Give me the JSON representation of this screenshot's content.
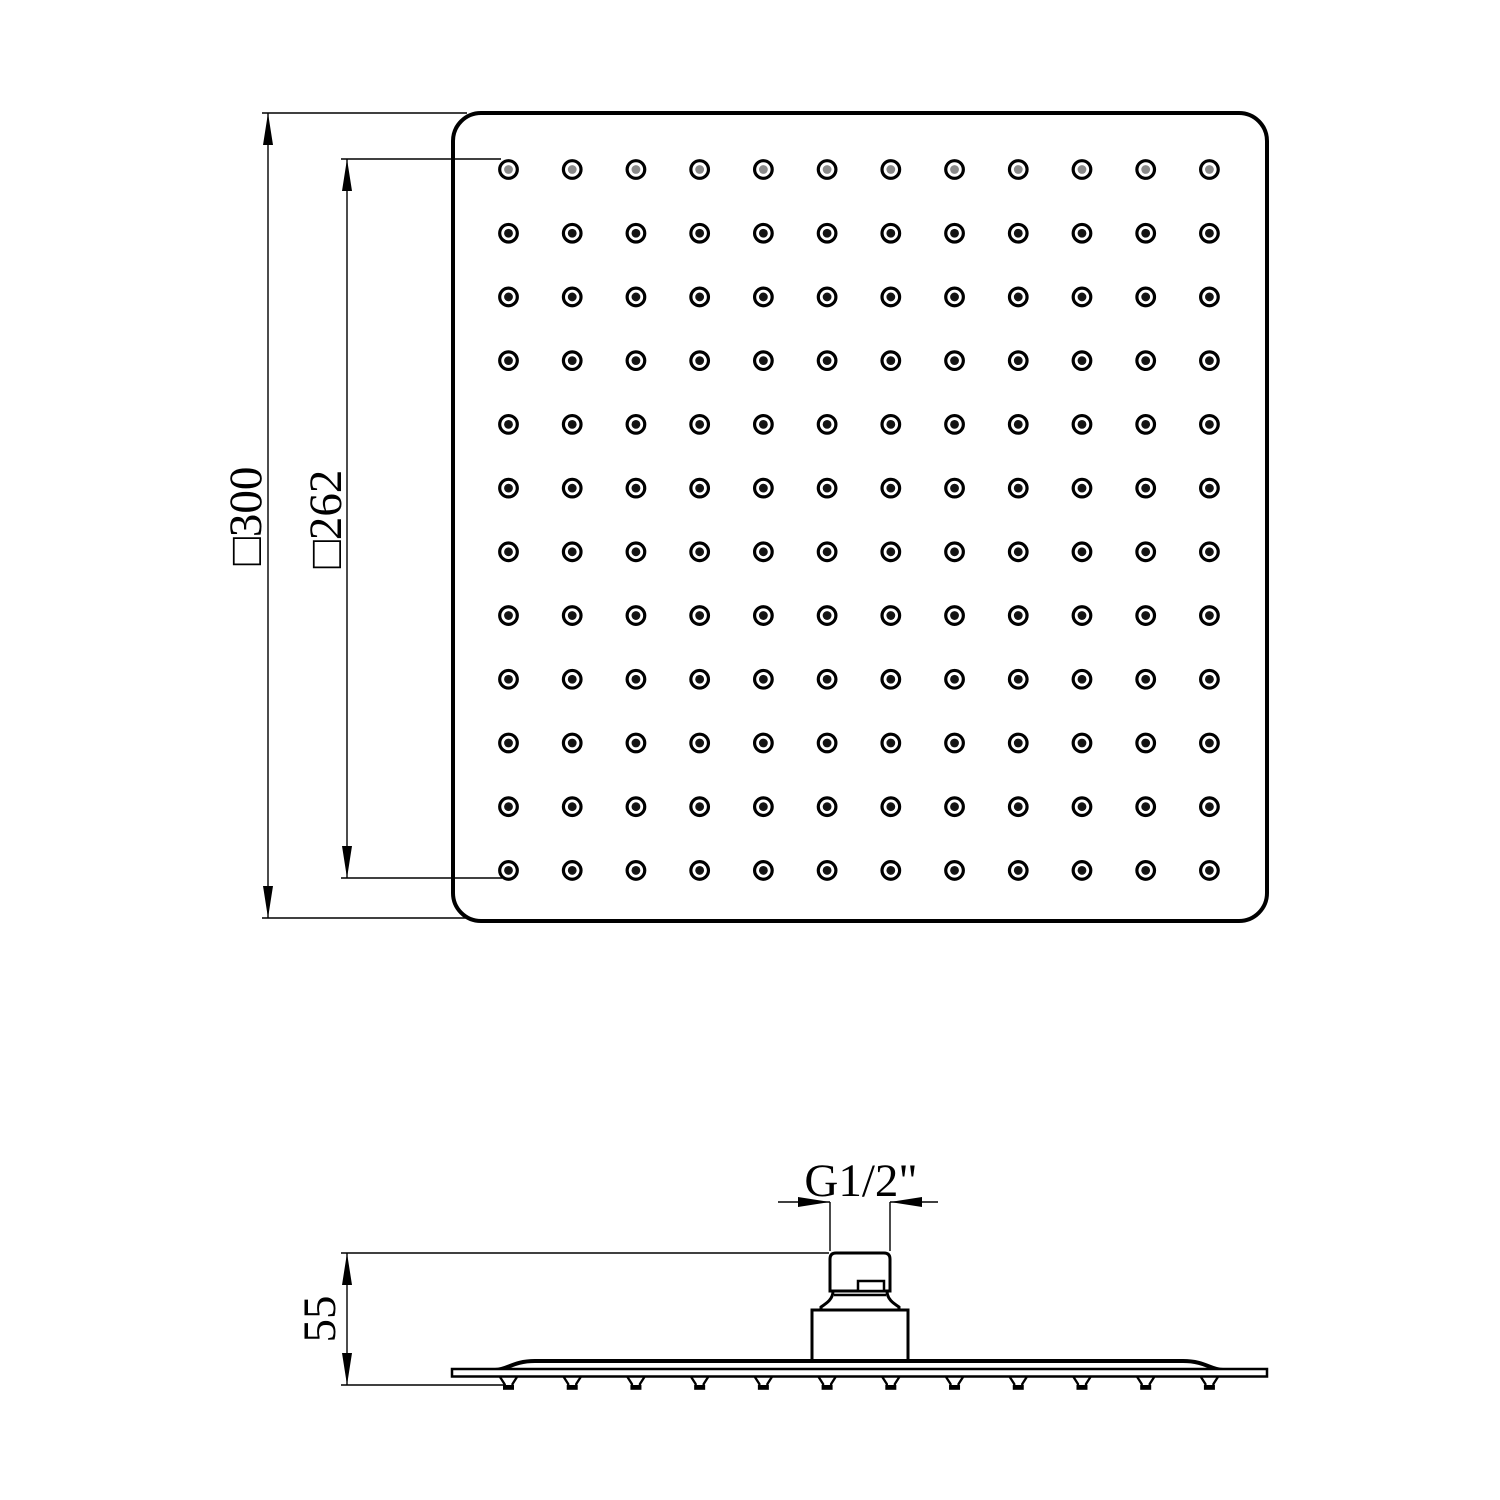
{
  "labels": {
    "top_outer": "□300",
    "top_inner": "□262",
    "side_height": "55",
    "side_thread": "G1/2\""
  },
  "top_view": {
    "nozzle_rows": 12,
    "nozzle_cols": 12,
    "first_row_dot_color": "#8a8a8a",
    "dot_color": "#141414",
    "ring_color": "#000000"
  },
  "side_view": {
    "teeth_count": 12
  },
  "colors": {
    "background": "#ffffff",
    "line": "#000000"
  }
}
